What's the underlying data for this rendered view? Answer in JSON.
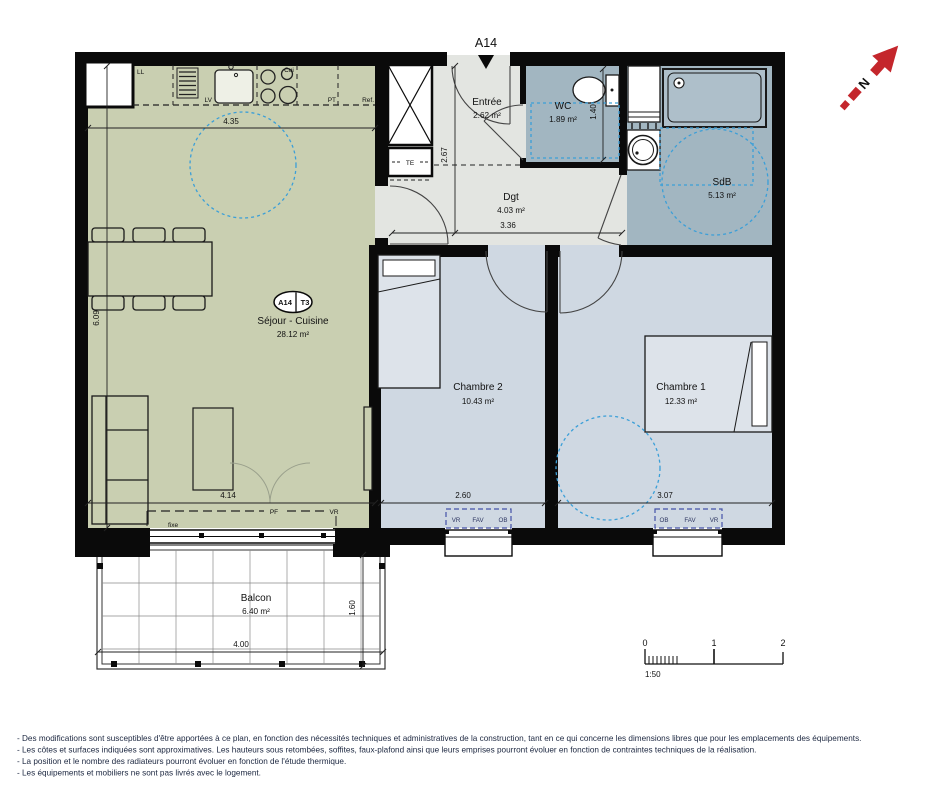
{
  "plan": {
    "unit": "A14",
    "badge": {
      "unit": "A14",
      "type": "T3"
    },
    "north_letter": "N",
    "rooms": {
      "sejour": {
        "name": "Séjour - Cuisine",
        "area": "28.12 m²"
      },
      "entree": {
        "name": "Entrée",
        "area": "2.62 m²"
      },
      "wc": {
        "name": "WC",
        "area": "1.89 m²"
      },
      "sdb": {
        "name": "SdB",
        "area": "5.13 m²"
      },
      "dgt": {
        "name": "Dgt",
        "area": "4.03 m²"
      },
      "chambre2": {
        "name": "Chambre 2",
        "area": "10.43 m²"
      },
      "chambre1": {
        "name": "Chambre 1",
        "area": "12.33 m²"
      },
      "balcon": {
        "name": "Balcon",
        "area": "6.40 m²"
      }
    },
    "dimensions": {
      "sejour_top": "4.35",
      "sejour_left": "6.09",
      "sejour_bottom": "4.14",
      "entree_height": "2.67",
      "wc_width": "1.40",
      "dgt_width": "3.36",
      "chambre2_width": "2.60",
      "chambre1_width": "3.07",
      "balcon_width": "4.00",
      "balcon_depth": "1.60"
    },
    "kitchen": {
      "ll": "LL",
      "lv": "LV",
      "cui": "Cui",
      "pt": "PT",
      "ref": "Ref."
    },
    "tags": {
      "te": "TE",
      "pf": "PF",
      "vr": "VR",
      "fixe": "fixe",
      "fav": "FAV",
      "ob": "OB"
    },
    "scalebar": {
      "t0": "0",
      "t1": "1",
      "t2": "2",
      "ratio": "1:50"
    },
    "colors": {
      "sejour": "#c9cfb1",
      "bedroom": "#cfd8e2",
      "wet": "#a2b6c1",
      "circulation": "#e3e5e1",
      "accessibility": "#3b9fd8",
      "window_tag": "#4452a8",
      "north_red": "#c4262c",
      "wall": "#0a0a0a"
    },
    "disclaimer": [
      "- Des modifications sont susceptibles d'être apportées à ce plan, en fonction des nécessités techniques et administratives de la construction, tant en ce qui concerne les dimensions libres que pour les emplacements des équipements.",
      "- Les côtes et surfaces indiquées sont approximatives. Les hauteurs sous retombées, soffites, faux-plafond ainsi que leurs emprises pourront évoluer en fonction de contraintes techniques de la réalisation.",
      "- La position et le nombre des radiateurs pourront évoluer en fonction de l'étude thermique.",
      "- Les équipements et mobiliers ne sont pas livrés avec le logement."
    ]
  }
}
